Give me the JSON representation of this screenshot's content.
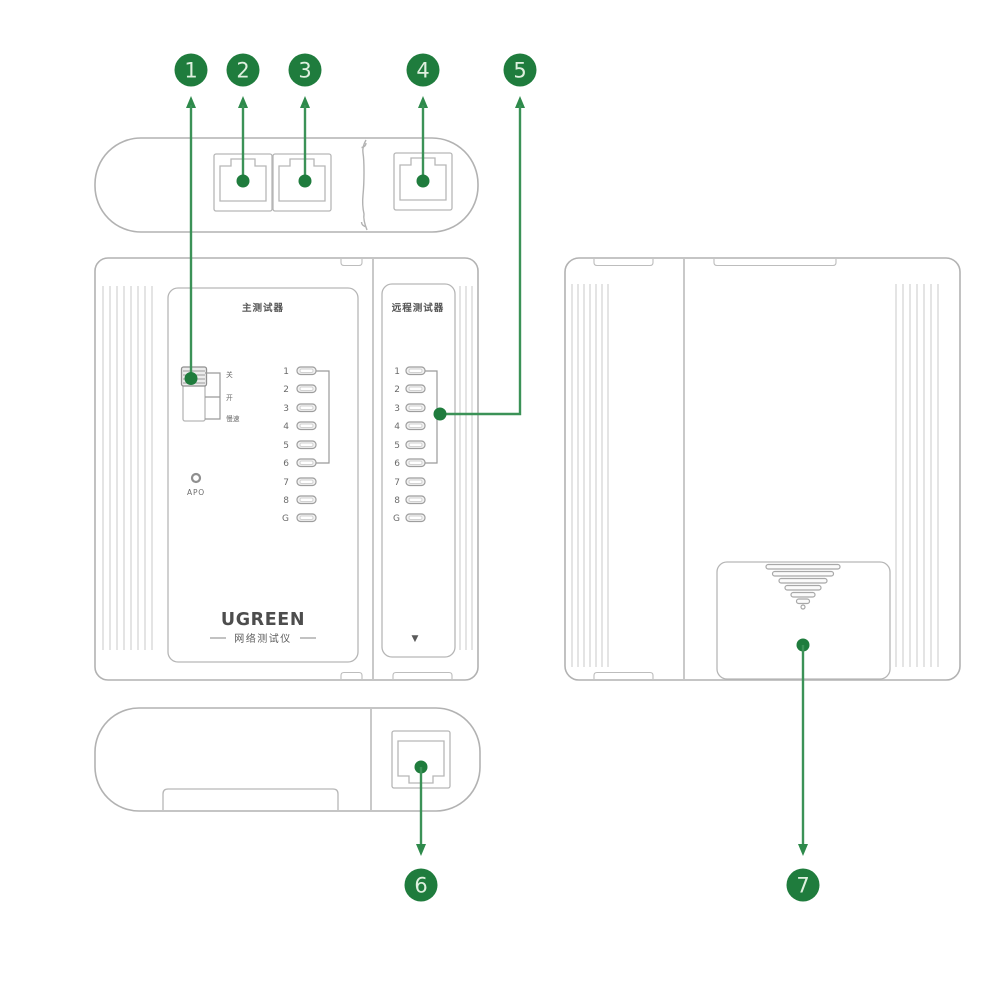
{
  "meta": {
    "accent_green": "#1f7c3d",
    "arrow_green": "#3b9257",
    "outline_gray": "#b2b2b2"
  },
  "callouts": {
    "n1": "1",
    "n2": "2",
    "n3": "3",
    "n4": "4",
    "n5": "5",
    "n6": "6",
    "n7": "7"
  },
  "front_view": {
    "main_panel": {
      "title": "主测试器",
      "switch_labels": [
        "关",
        "开",
        "慢速"
      ],
      "apo_label": "APO",
      "led_labels": [
        "1",
        "2",
        "3",
        "4",
        "5",
        "6",
        "7",
        "8",
        "G"
      ],
      "brand": "UGREEN",
      "brand_subtitle": "网络测试仪"
    },
    "remote_panel": {
      "title": "远程测试器",
      "led_labels": [
        "1",
        "2",
        "3",
        "4",
        "5",
        "6",
        "7",
        "8",
        "G"
      ],
      "insert_arrow_glyph": "▼"
    }
  }
}
